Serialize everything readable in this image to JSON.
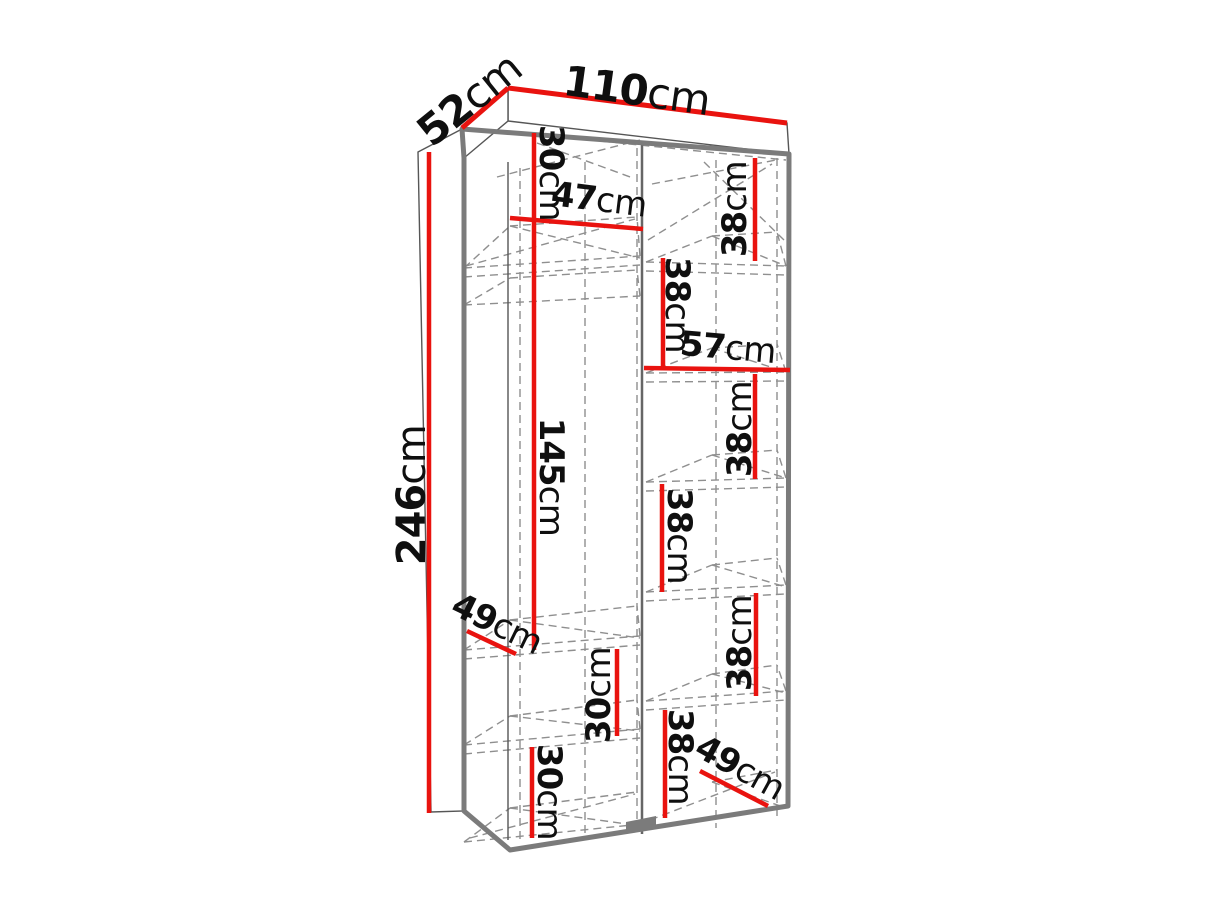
{
  "colors": {
    "dimension_line": "#e9130f",
    "outline": "#7b7b7b",
    "dashed_line": "#8f8f8f",
    "label_text": "#0f0f0f",
    "background": "#ffffff"
  },
  "dimensions": {
    "width": {
      "value": "110",
      "unit": "cm"
    },
    "depth": {
      "value": "52",
      "unit": "cm"
    },
    "height": {
      "value": "246",
      "unit": "cm"
    },
    "left": {
      "top_section": {
        "value": "30",
        "unit": "cm"
      },
      "inner_width": {
        "value": "47",
        "unit": "cm"
      },
      "hanging_section": {
        "value": "145",
        "unit": "cm"
      },
      "shelf_depth": {
        "value": "49",
        "unit": "cm"
      },
      "middle_section": {
        "value": "30",
        "unit": "cm"
      },
      "bottom_section": {
        "value": "30",
        "unit": "cm"
      }
    },
    "right": {
      "inner_width": {
        "value": "57",
        "unit": "cm"
      },
      "shelf_depth": {
        "value": "49",
        "unit": "cm"
      },
      "section1": {
        "value": "38",
        "unit": "cm"
      },
      "section2": {
        "value": "38",
        "unit": "cm"
      },
      "section3": {
        "value": "38",
        "unit": "cm"
      },
      "section4": {
        "value": "38",
        "unit": "cm"
      },
      "section5": {
        "value": "38",
        "unit": "cm"
      },
      "section6": {
        "value": "38",
        "unit": "cm"
      }
    }
  }
}
